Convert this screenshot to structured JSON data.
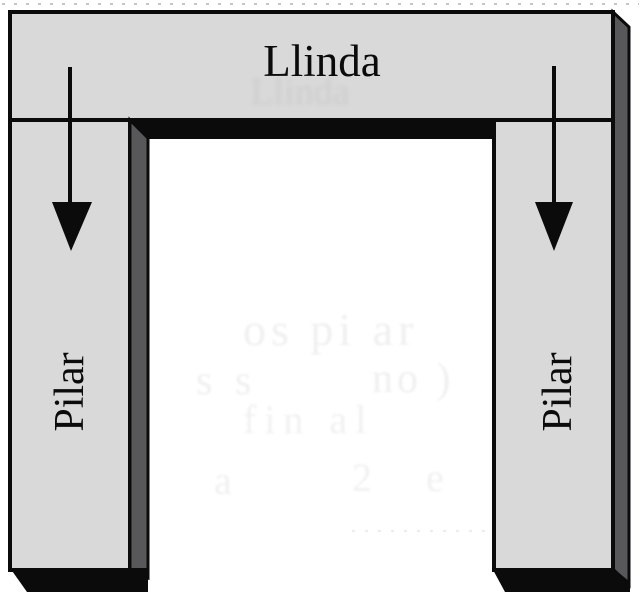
{
  "figure": {
    "lintel": {
      "label": "Llinda"
    },
    "pillars": {
      "left_label": "Pilar",
      "right_label": "Pilar"
    },
    "arrows": {
      "left_icon": "down-arrow",
      "right_icon": "down-arrow",
      "count": 2,
      "direction": "down"
    },
    "colors": {
      "stone_face": "#d9d9d9",
      "stone_side_shadow": "#58585a",
      "outline_black": "#0b0b0b",
      "paper_white": "#ffffff",
      "bleedthrough_gray": "#f0f0f0"
    },
    "bleedthrough": {
      "under_title": "Llinda",
      "fragments": [
        "os pi ar",
        "s s",
        "no )",
        "fin al",
        "a",
        "2 e"
      ]
    }
  }
}
